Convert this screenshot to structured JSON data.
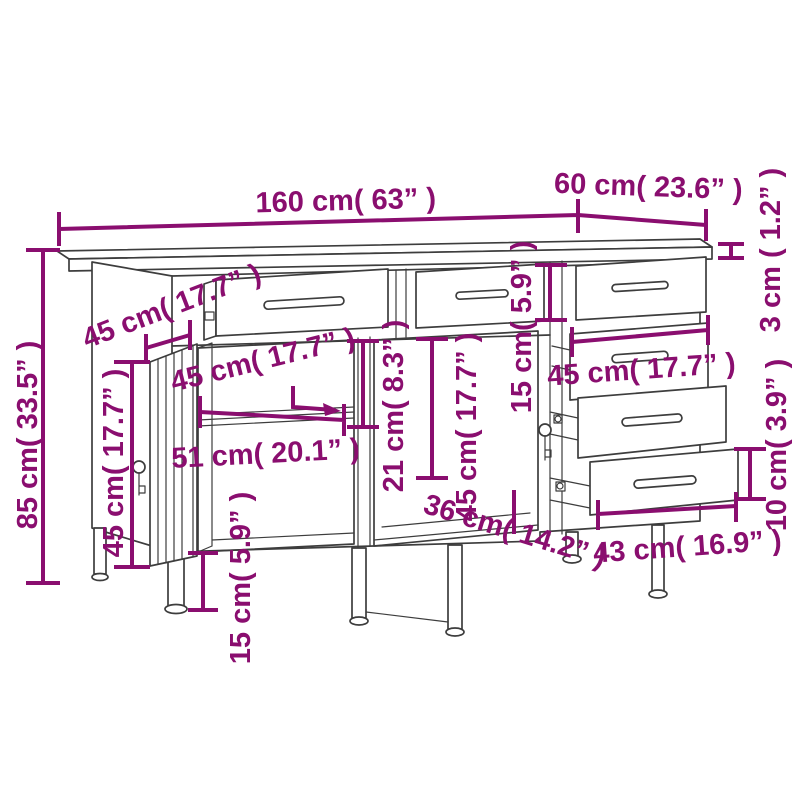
{
  "page": {
    "background": "#ffffff"
  },
  "colors": {
    "annotation": "#8A0E6F",
    "linework": "#3d3d3d"
  },
  "diagram": {
    "kind": "furniture-dimension-drawing",
    "subject": "workbench with top drawers, door cabinet and drawer stack",
    "dimensions": {
      "w160": {
        "of": "overall width",
        "label": "160 cm( 63” )"
      },
      "d60": {
        "of": "overall depth",
        "label": "60 cm( 23.6” )"
      },
      "t3": {
        "of": "tabletop thickness",
        "label": "3 cm ( 1.2” )"
      },
      "side45": {
        "of": "side panel depth",
        "label": "45 cm( 17.7” )"
      },
      "shelf45": {
        "of": "shelf depth",
        "label": "45 cm( 17.7” )"
      },
      "drw15": {
        "of": "top drawer height",
        "label": "15 cm( 5.9” )"
      },
      "h85": {
        "of": "overall height",
        "label": "85 cm( 33.5” )"
      },
      "door45": {
        "of": "door height",
        "label": "45 cm( 17.7” )"
      },
      "w51": {
        "of": "compartment width",
        "label": "51 cm( 20.1” )"
      },
      "h21": {
        "of": "upper compartment height",
        "label": "21 cm( 8.3” )"
      },
      "mid45": {
        "of": "middle compartment height",
        "label": "45 cm( 17.7” )"
      },
      "dw45": {
        "of": "drawer width",
        "label": "45 cm( 17.7” )"
      },
      "dfh10": {
        "of": "drawer front height",
        "label": "10 cm( 3.9” )"
      },
      "dl43": {
        "of": "drawer length",
        "label": "43 cm( 16.9” )"
      },
      "dd36": {
        "of": "drawer inner depth",
        "label": "36 cm( 14.2” )"
      },
      "leg15": {
        "of": "leg height",
        "label": "15 cm( 5.9” )"
      }
    }
  }
}
